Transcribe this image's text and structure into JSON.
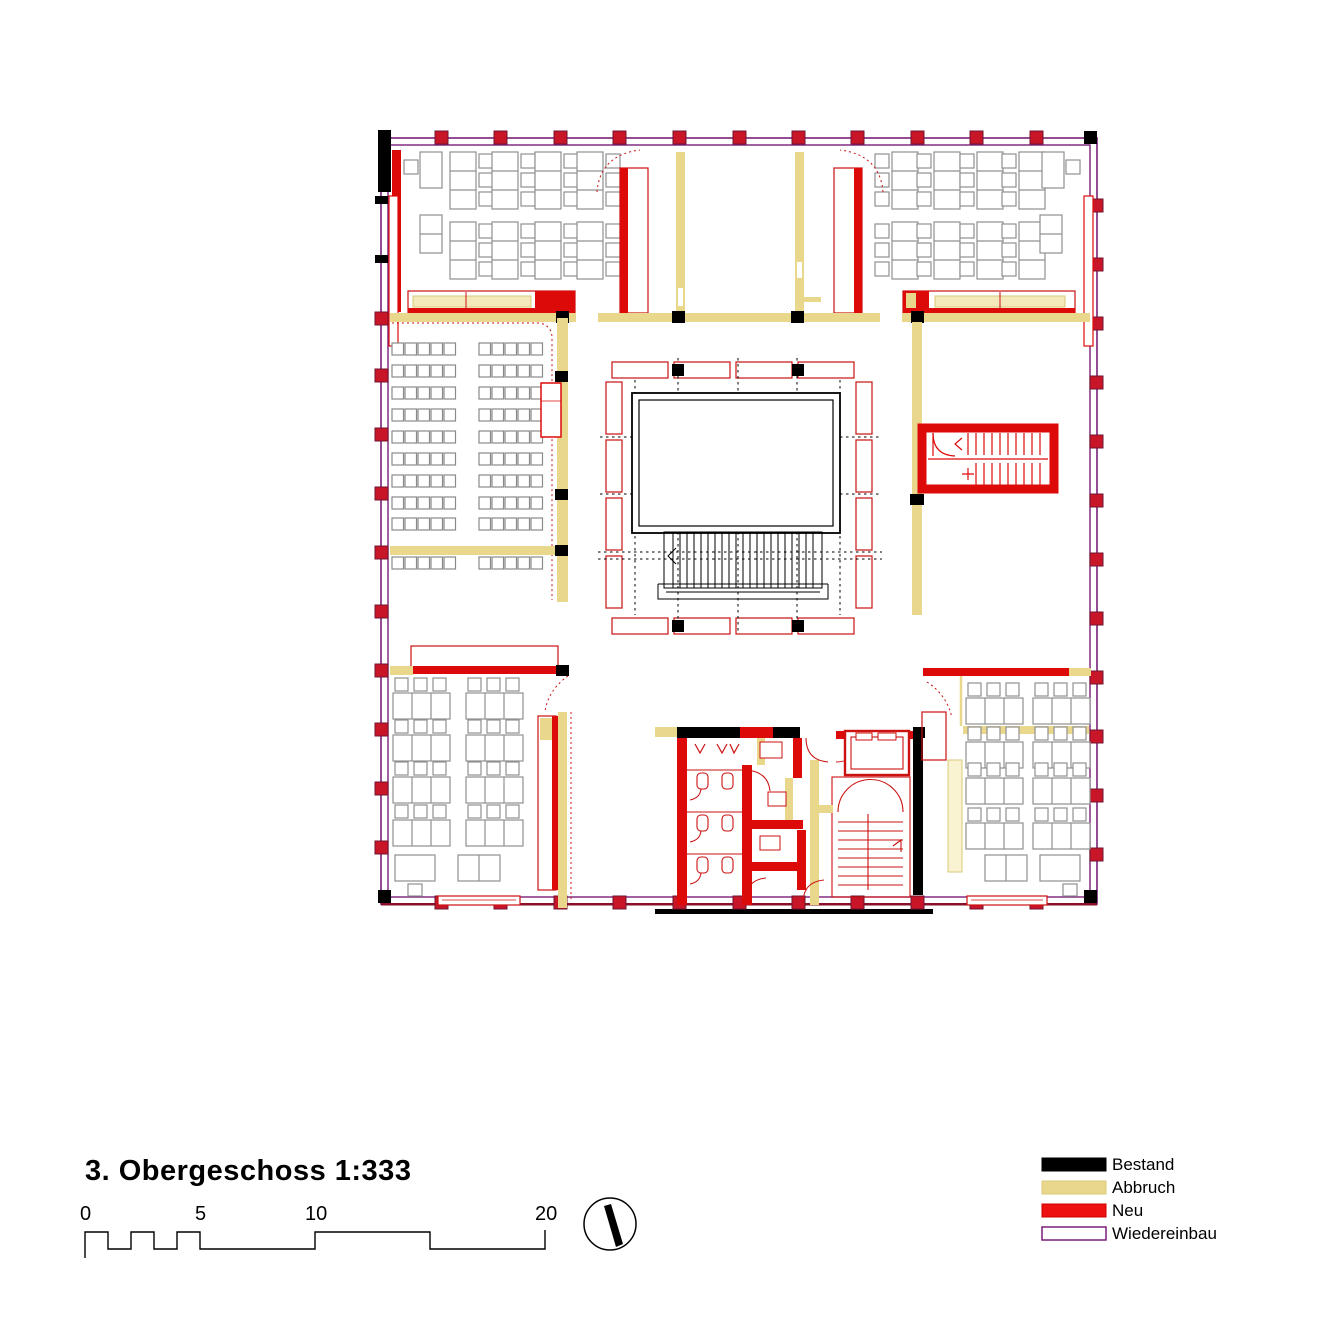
{
  "page": {
    "title": "3. Obergeschoss 1:333",
    "type_note": "architectural floor plan, 3rd upper floor, scale 1:333"
  },
  "scalebar": {
    "labels": [
      "0",
      "5",
      "10",
      "20"
    ],
    "unit": "m"
  },
  "north_arrow": {
    "icon": "compass-needle-icon"
  },
  "legend": {
    "items": [
      {
        "label": "Bestand",
        "color": "#000000"
      },
      {
        "label": "Abbruch",
        "color": "#e9d78b"
      },
      {
        "label": "Neu",
        "color": "#ee1111"
      },
      {
        "label": "Wiedereinbau",
        "color": "#ffffff",
        "border": "#7a1f7a"
      }
    ]
  },
  "palette": {
    "bestand_black": "#000000",
    "abbruch_yellow": "#e9d78b",
    "neu_red": "#dd0a0a",
    "wiedereinbau_purple": "#7a1f7a",
    "column_red": "#c81528",
    "furniture_gray": "#909090"
  }
}
